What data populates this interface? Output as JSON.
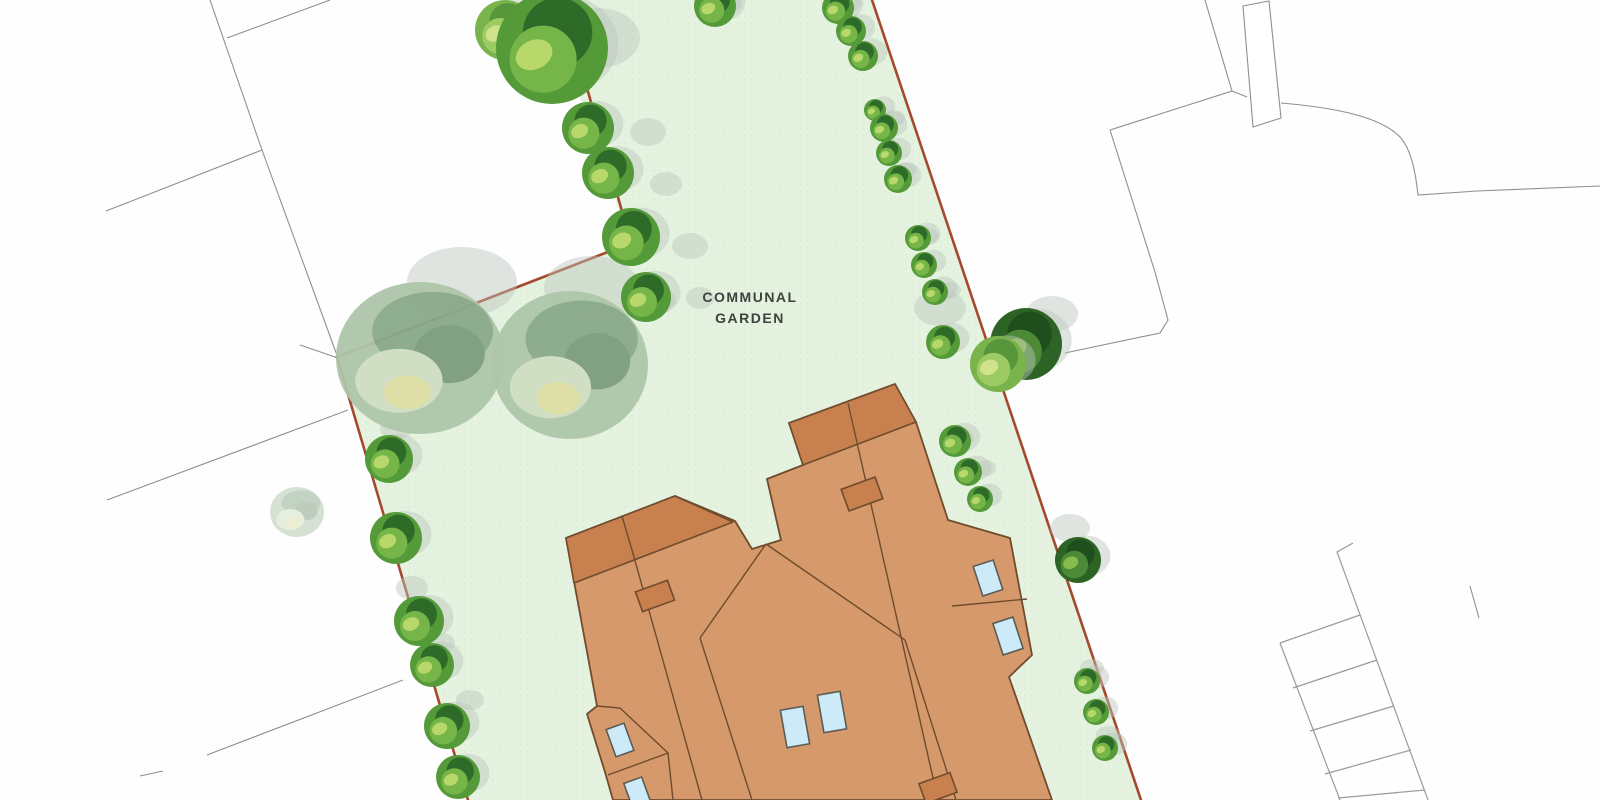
{
  "plan": {
    "title": "site-plan",
    "garden": {
      "label_line1": "COMMUNAL",
      "label_line2": "GARDEN",
      "label_color": "#3b433d",
      "fill": "#e4f2df",
      "texture_dot": "#d7ebd3"
    },
    "colors": {
      "background": "#fefefe",
      "boundary_red": "#a4492e",
      "plot_line_gray": "#8f8f8f",
      "parking_gray": "#9a9a9a",
      "roof_main": "#d6996b",
      "roof_dark": "#c8804e",
      "roof_outline": "#6f4c2d",
      "skylight_blue": "#cdeaf8",
      "skylight_outline": "#5b5c54",
      "shadow_gray": "#bcc5bc"
    },
    "garden_outline": "562,0 872,0 1141,800 468,800 337,357 631,243 600,158 570,68",
    "boundary_segments": [
      "562,0 631,243",
      "631,243 337,357",
      "337,357 468,800",
      "872,0 1141,800"
    ],
    "plot_lines": [
      "210,0 262,150 338,358",
      "227,38 330,0",
      "106,211 262,150",
      "300,345 338,358",
      "348,410 107,500",
      "403,680 207,755",
      "163,771 140,776",
      "1205,0 1232,91 1110,130",
      "1232,91 1247,97",
      "1110,130 1155,272 1168,320 1160,333 1065,353",
      "1470,586 1479,618"
    ],
    "outbuilding": "1243,6 1269,1 1281,118 1253,127",
    "road_curve": "M1281,103 C1340,108 1382,118 1400,137 C1412,150 1416,176 1418,195 L1477,191 L1600,186",
    "parking": [
      "1353,543 1337,552 1428,800",
      "1280,643 1340,800",
      "1360,615 1280,643",
      "1377,660 1293,688",
      "1394,706 1310,731",
      "1411,750 1325,774",
      "1425,790 1338,798"
    ],
    "building": {
      "outline": "M566,538 L675,496 L735,521 L752,549 L781,540 L767,479 L803,465 L789,423 L895,384 L916,422 L948,520 L1010,538 L1032,655 L1009,677 L1052,800 L613,800 L605,772 L587,714 L597,706 Z",
      "dark_blocks": [
        "M566,538 L675,496 L733,522 L574,583 Z",
        "M789,423 L895,384 L916,422 L803,465 Z"
      ],
      "inner_lines": [
        "M622,516 L634,557",
        "M634,557 L702,800",
        "M848,403 L858,447",
        "M858,447 L938,800",
        "M766,544 L700,638",
        "M766,544 L905,640",
        "M700,638 L752,800",
        "M905,640 L956,800",
        "M597,706 L620,708 L668,753 L608,775",
        "M668,753 L673,800",
        "M952,606 L1027,599"
      ],
      "skylights": [
        [
          620,
          740,
          19,
          29,
          -20
        ],
        [
          637,
          792,
          19,
          25,
          -20
        ],
        [
          795,
          727,
          23,
          38,
          -10
        ],
        [
          832,
          712,
          23,
          38,
          -10
        ],
        [
          988,
          578,
          21,
          31,
          -18
        ],
        [
          1008,
          636,
          21,
          33,
          -18
        ]
      ],
      "chimneys": [
        [
          655,
          596,
          34,
          21,
          -20
        ],
        [
          862,
          494,
          36,
          23,
          -20
        ],
        [
          938,
          788,
          33,
          21,
          -20
        ]
      ]
    },
    "trees": [
      {
        "x": 505,
        "y": 30,
        "r": 30,
        "v": "light"
      },
      {
        "x": 552,
        "y": 48,
        "r": 56,
        "v": "bright"
      },
      {
        "x": 588,
        "y": 128,
        "r": 26,
        "v": "bright"
      },
      {
        "x": 608,
        "y": 173,
        "r": 26,
        "v": "bright"
      },
      {
        "x": 631,
        "y": 237,
        "r": 29,
        "v": "bright"
      },
      {
        "x": 646,
        "y": 297,
        "r": 25,
        "v": "bright"
      },
      {
        "x": 715,
        "y": 6,
        "r": 21,
        "v": "bright"
      },
      {
        "x": 838,
        "y": 8,
        "r": 16,
        "v": "bright"
      },
      {
        "x": 851,
        "y": 31,
        "r": 15,
        "v": "bright"
      },
      {
        "x": 863,
        "y": 56,
        "r": 15,
        "v": "bright"
      },
      {
        "x": 875,
        "y": 110,
        "r": 11,
        "v": "bright"
      },
      {
        "x": 884,
        "y": 128,
        "r": 14,
        "v": "bright"
      },
      {
        "x": 889,
        "y": 153,
        "r": 13,
        "v": "bright"
      },
      {
        "x": 898,
        "y": 179,
        "r": 14,
        "v": "bright"
      },
      {
        "x": 918,
        "y": 238,
        "r": 13,
        "v": "bright"
      },
      {
        "x": 924,
        "y": 265,
        "r": 13,
        "v": "bright"
      },
      {
        "x": 935,
        "y": 292,
        "r": 13,
        "v": "bright"
      },
      {
        "x": 943,
        "y": 342,
        "r": 17,
        "v": "bright"
      },
      {
        "x": 1026,
        "y": 344,
        "r": 36,
        "v": "dark"
      },
      {
        "x": 998,
        "y": 364,
        "r": 28,
        "v": "light"
      },
      {
        "x": 955,
        "y": 441,
        "r": 16,
        "v": "bright"
      },
      {
        "x": 968,
        "y": 472,
        "r": 14,
        "v": "bright"
      },
      {
        "x": 980,
        "y": 499,
        "r": 13,
        "v": "bright"
      },
      {
        "x": 1078,
        "y": 560,
        "r": 23,
        "v": "dark"
      },
      {
        "x": 1087,
        "y": 681,
        "r": 13,
        "v": "bright"
      },
      {
        "x": 1096,
        "y": 712,
        "r": 13,
        "v": "bright"
      },
      {
        "x": 1105,
        "y": 748,
        "r": 13,
        "v": "bright"
      },
      {
        "x": 389,
        "y": 459,
        "r": 24,
        "v": "bright"
      },
      {
        "x": 396,
        "y": 538,
        "r": 26,
        "v": "bright"
      },
      {
        "x": 419,
        "y": 621,
        "r": 25,
        "v": "bright"
      },
      {
        "x": 432,
        "y": 665,
        "r": 22,
        "v": "bright"
      },
      {
        "x": 447,
        "y": 726,
        "r": 23,
        "v": "bright"
      },
      {
        "x": 458,
        "y": 777,
        "r": 22,
        "v": "bright"
      }
    ],
    "sage_trees": [
      {
        "x": 420,
        "y": 358,
        "rx": 84,
        "ry": 76,
        "op": 0.95
      },
      {
        "x": 570,
        "y": 365,
        "rx": 78,
        "ry": 74,
        "op": 0.95
      },
      {
        "x": 297,
        "y": 512,
        "rx": 27,
        "ry": 25,
        "op": 0.5
      }
    ],
    "shadow_puffs": [
      [
        598,
        38,
        42,
        30
      ],
      [
        648,
        132,
        18,
        14
      ],
      [
        666,
        184,
        16,
        12
      ],
      [
        690,
        246,
        18,
        13
      ],
      [
        700,
        298,
        14,
        11
      ],
      [
        462,
        282,
        55,
        35
      ],
      [
        592,
        288,
        48,
        32
      ],
      [
        660,
        300,
        16,
        11
      ],
      [
        940,
        308,
        26,
        18
      ],
      [
        1052,
        314,
        26,
        18
      ],
      [
        1070,
        528,
        20,
        14
      ],
      [
        894,
        118,
        11,
        8
      ],
      [
        906,
        170,
        11,
        8
      ],
      [
        928,
        236,
        11,
        8
      ],
      [
        950,
        290,
        11,
        8
      ],
      [
        962,
        438,
        12,
        9
      ],
      [
        986,
        468,
        10,
        8
      ],
      [
        396,
        428,
        16,
        12
      ],
      [
        412,
        588,
        16,
        12
      ],
      [
        441,
        643,
        14,
        10
      ],
      [
        470,
        700,
        14,
        10
      ],
      [
        848,
        2,
        14,
        10
      ],
      [
        730,
        3,
        12,
        9
      ],
      [
        1092,
        668,
        12,
        9
      ],
      [
        1108,
        735,
        12,
        9
      ]
    ],
    "tree_palettes": {
      "bright": {
        "base": "#549a39",
        "cap": "#2f6b28",
        "mid": "#76b548",
        "light": "#c0dc6f"
      },
      "dark": {
        "base": "#2e6326",
        "cap": "#1f4f1d",
        "mid": "#4d8a38",
        "light": "#8fc050"
      },
      "light": {
        "base": "#79b34c",
        "cap": "#57963a",
        "mid": "#9ccb63",
        "light": "#d6e690"
      },
      "sage": {
        "base": "#aec6aa",
        "cap": "#8aa98a",
        "blotch": "#7d9d80",
        "light": "#cfdfc2",
        "yellow": "#dedfa5"
      }
    }
  }
}
